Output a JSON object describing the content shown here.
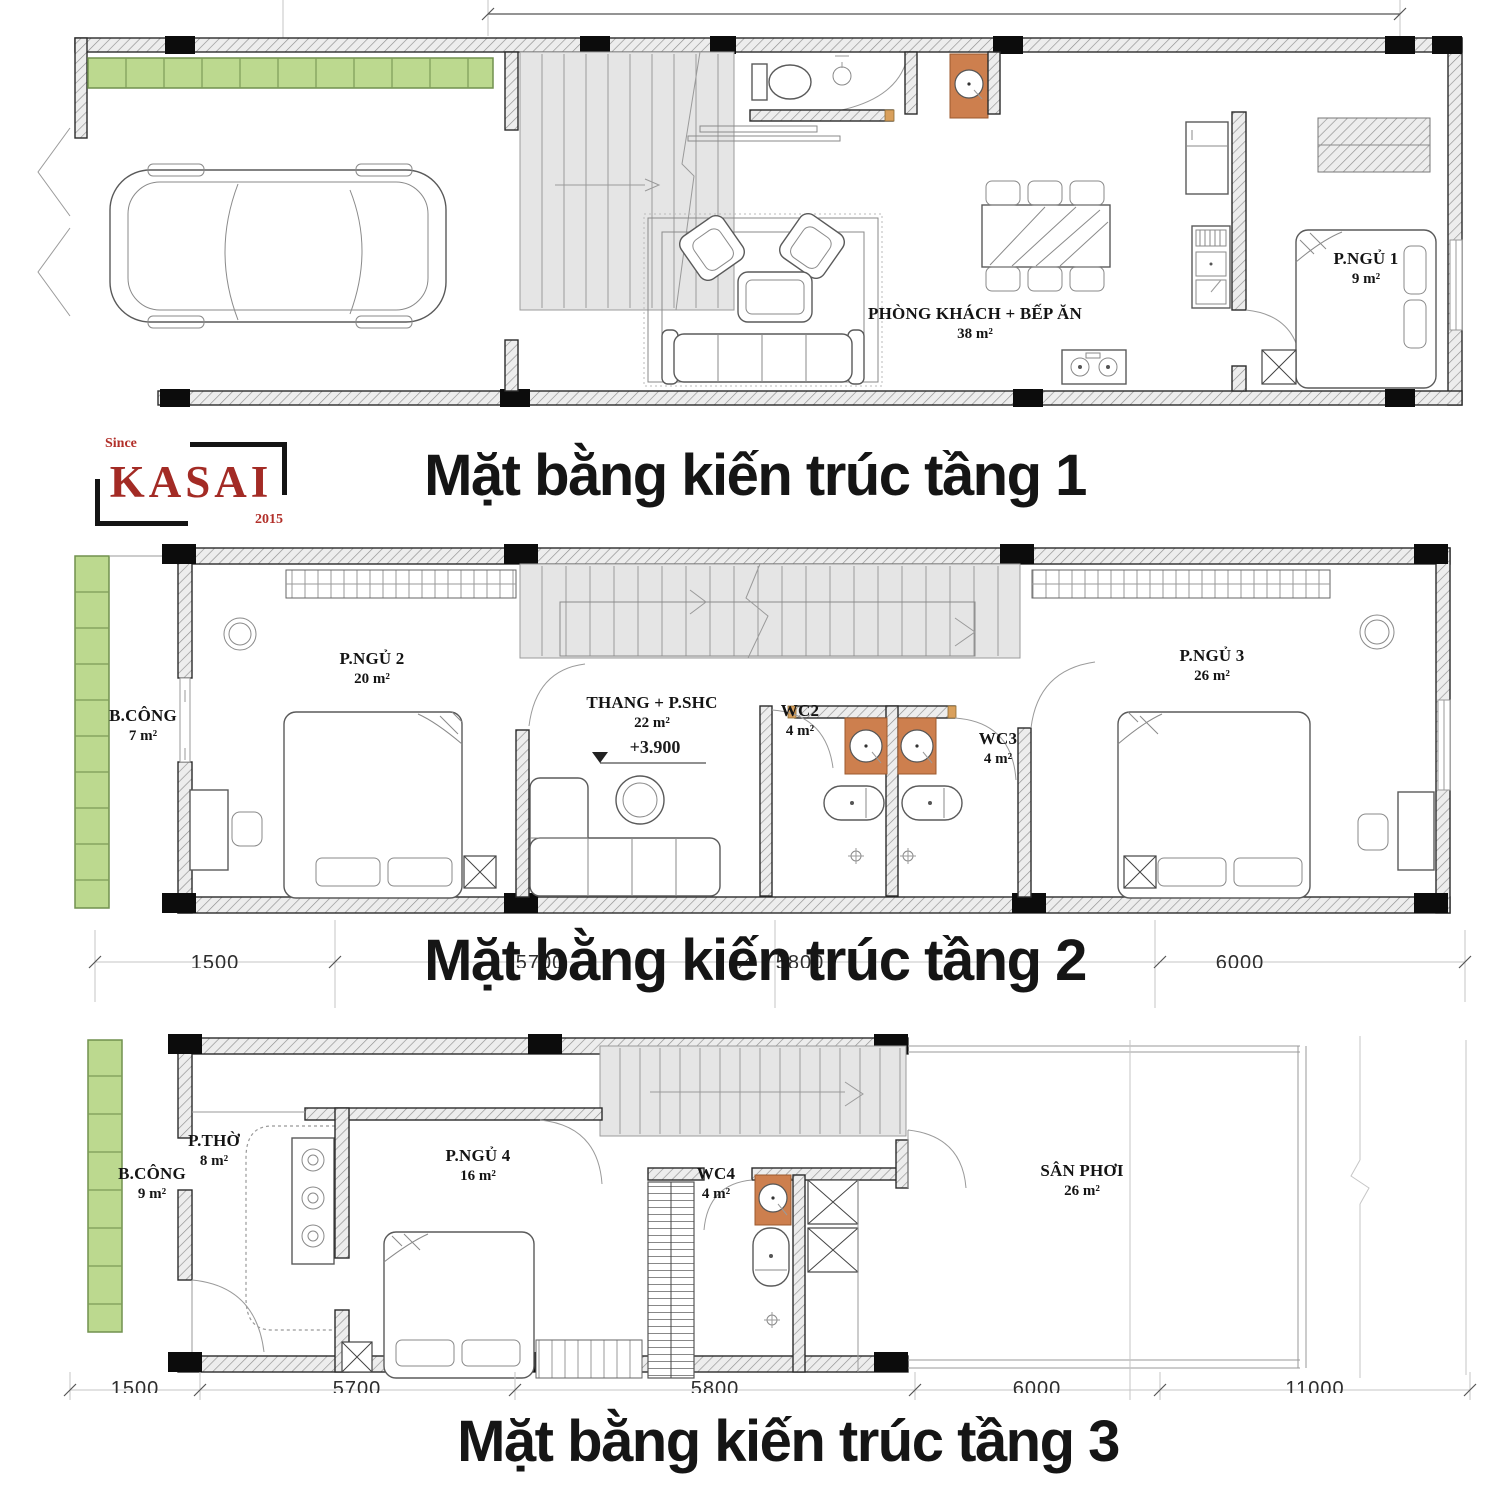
{
  "logo": {
    "since": "Since",
    "name": "KASAI",
    "year": "2015"
  },
  "colors": {
    "planter_green": "#bcd98f",
    "counter_orange": "#cd7f4e",
    "logo_red": "#a32b25",
    "wall_dark": "#141414",
    "stair_gray": "#e5e5e5"
  },
  "floors": [
    {
      "title": "Mặt bằng kiến trúc tầng 1",
      "rooms": [
        {
          "name": "PHÒNG KHÁCH + BẾP ĂN",
          "area": "38 m²"
        },
        {
          "name": "P.NGỦ 1",
          "area": "9 m²"
        }
      ],
      "dimensions": []
    },
    {
      "title": "Mặt bằng kiến trúc tầng 2",
      "rooms": [
        {
          "name": "B.CÔNG",
          "area": "7 m²"
        },
        {
          "name": "P.NGỦ 2",
          "area": "20 m²"
        },
        {
          "name": "THANG + P.SHC",
          "area": "22 m²",
          "level": "+3.900"
        },
        {
          "name": "WC2",
          "area": "4 m²"
        },
        {
          "name": "WC3",
          "area": "4 m²"
        },
        {
          "name": "P.NGỦ 3",
          "area": "26 m²"
        }
      ],
      "dimensions": [
        "1500",
        "5700",
        "5800",
        "6000"
      ]
    },
    {
      "title": "Mặt bằng kiến trúc tầng 3",
      "rooms": [
        {
          "name": "B.CÔNG",
          "area": "9 m²"
        },
        {
          "name": "P.THỜ",
          "area": "8 m²"
        },
        {
          "name": "P.NGỦ 4",
          "area": "16 m²"
        },
        {
          "name": "WC4",
          "area": "4 m²"
        },
        {
          "name": "SÂN PHƠI",
          "area": "26 m²"
        }
      ],
      "dimensions": [
        "1500",
        "5700",
        "5800",
        "6000",
        "11000"
      ]
    }
  ]
}
